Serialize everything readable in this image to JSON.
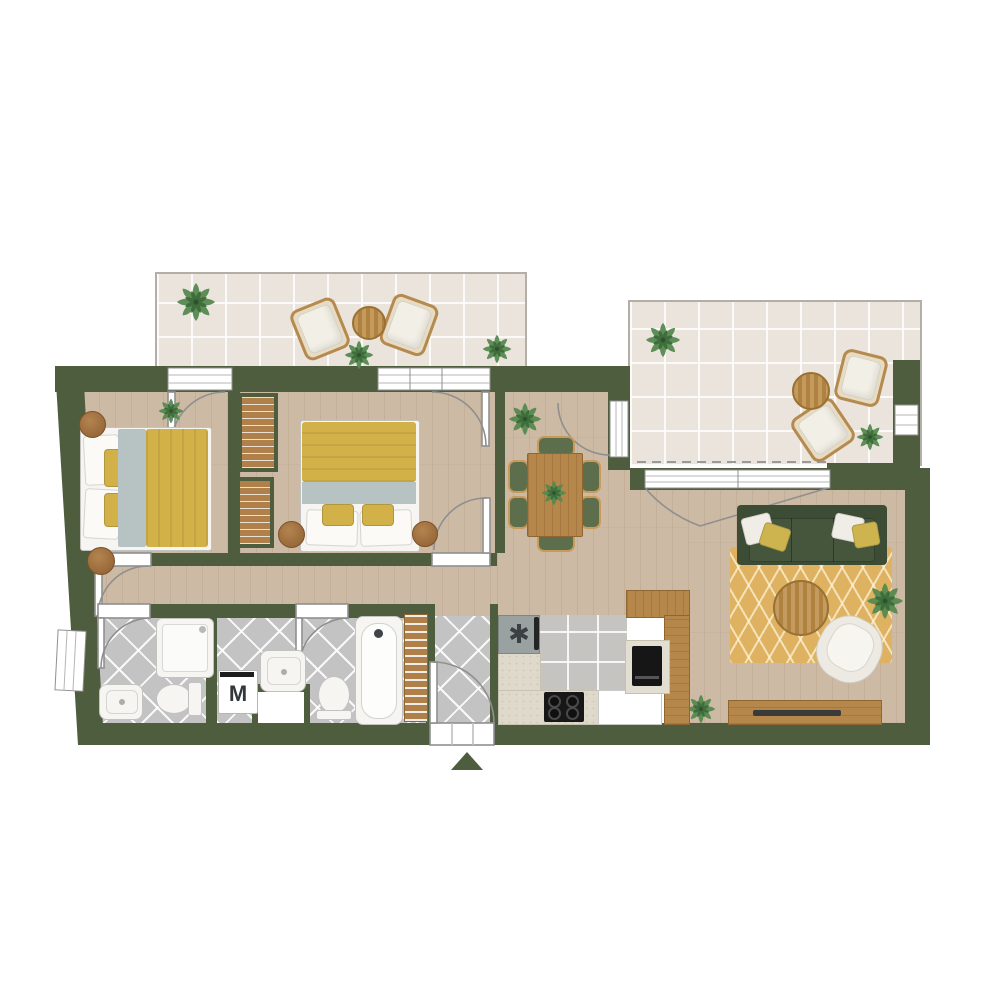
{
  "plan": {
    "type": "apartment-floor-plan-top-view",
    "labels": {
      "washing_machine": "M"
    },
    "icons": {
      "kitchen_sink": "✱",
      "entrance_marker": "triangle-up"
    },
    "colors": {
      "wall": "#4d5d3e",
      "wood_floor": "#cdbaa5",
      "balcony_tile": "#eae4dc",
      "bath_tile": "#c3c3c3",
      "counter": "#ded9cb",
      "bed_yellow": "#d2b149",
      "throw_gray": "#b7c3c3",
      "sofa_green": "#3d4d35",
      "chair_green": "#5c6e4b",
      "rug_yellow": "#dfb261",
      "furniture_wood": "#b5874a",
      "plant_green": "#568a50",
      "plant_green_dark": "#3f6e3c",
      "white_fixture": "#f6f5f1"
    },
    "rooms": [
      {
        "name": "balcony-top-left",
        "furniture": [
          "lounge-chair",
          "lounge-chair",
          "round-table",
          "plant",
          "plant",
          "plant"
        ]
      },
      {
        "name": "balcony-top-right",
        "furniture": [
          "lounge-chair",
          "lounge-chair",
          "round-table",
          "plant",
          "plant"
        ]
      },
      {
        "name": "bedroom-1",
        "furniture": [
          "double-bed",
          "pouf",
          "pouf",
          "plant"
        ]
      },
      {
        "name": "bedroom-2",
        "furniture": [
          "double-bed",
          "wardrobe",
          "wardrobe",
          "pouf",
          "pouf"
        ]
      },
      {
        "name": "dining-area",
        "furniture": [
          "dining-table",
          "chair",
          "chair",
          "chair",
          "chair",
          "chair",
          "chair",
          "plant",
          "plant"
        ]
      },
      {
        "name": "living-room",
        "furniture": [
          "sofa",
          "rug",
          "coffee-table",
          "armchair",
          "tv-sideboard",
          "plant",
          "plant"
        ]
      },
      {
        "name": "kitchen",
        "furniture": [
          "sink",
          "cooktop",
          "oven",
          "appliance",
          "tall-cabinets"
        ]
      },
      {
        "name": "bathroom-1",
        "furniture": [
          "shower",
          "washbasin",
          "toilet",
          "window"
        ]
      },
      {
        "name": "bathroom-2",
        "furniture": [
          "washing-machine",
          "washbasin",
          "toilet",
          "bathtub",
          "towel-rack"
        ]
      },
      {
        "name": "entrance-hall",
        "furniture": [
          "entrance-door"
        ]
      }
    ]
  }
}
